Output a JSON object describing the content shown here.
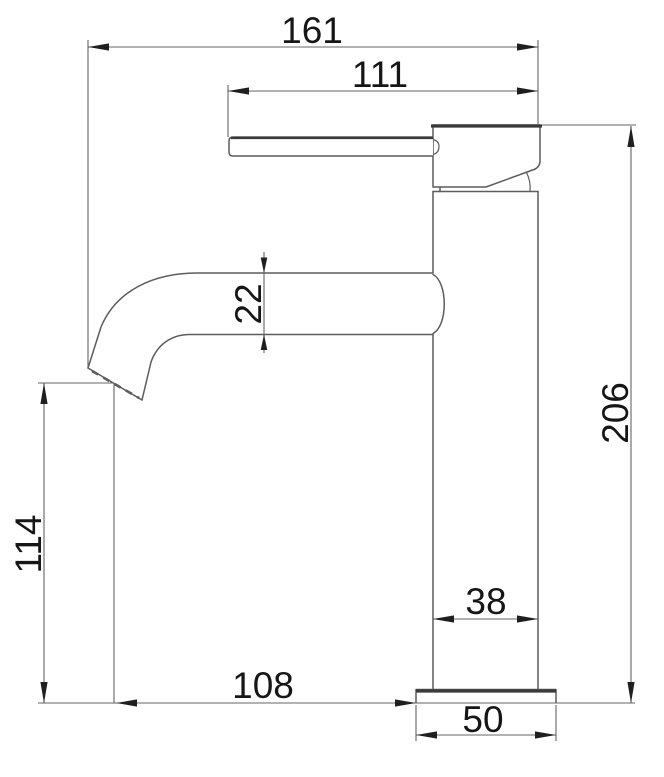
{
  "drawing": {
    "type": "technical-dimension-drawing",
    "subject": "single-lever basin mixer faucet side view",
    "dimensions": {
      "overall_width": "161",
      "handle_reach": "111",
      "spout_tube": "22",
      "overall_height": "206",
      "outlet_height": "114",
      "spout_reach": "108",
      "body_width": "38",
      "base_width": "50"
    }
  },
  "colors": {
    "line": "#5c5c5c",
    "dim": "#646464",
    "emphasis": "#3a3a3a",
    "arrow": "#1f1f1f",
    "text": "#161616",
    "bg": "#ffffff"
  }
}
